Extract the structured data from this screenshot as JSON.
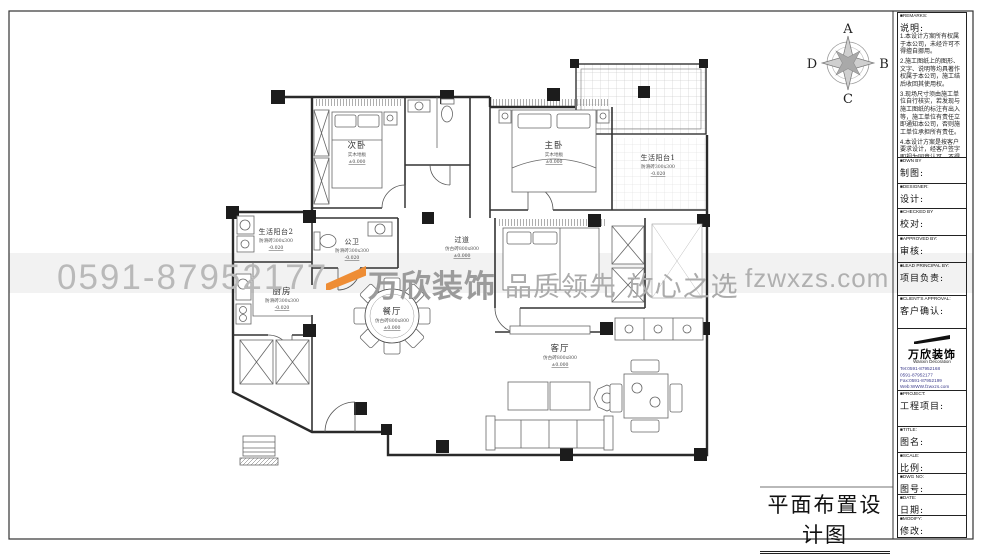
{
  "sheet": {
    "drawing_title": "平面布置设计图",
    "compass": {
      "top": "A",
      "right": "B",
      "bottom": "C",
      "left": "D"
    }
  },
  "watermark": {
    "phone": "0591-87952177",
    "brand": "万欣装饰",
    "slogan": "品质领先 放心之选",
    "website": "fzwxzs.com",
    "accent_color": "#ee8d35"
  },
  "rooms": {
    "ciwo": {
      "name": "次卧",
      "note": "实木地板",
      "elev": "±0.000"
    },
    "zhuwo": {
      "name": "主卧",
      "note": "实木地板",
      "elev": "±0.000"
    },
    "yangtai1": {
      "name": "生活阳台1",
      "note": "防滑砖300x300",
      "elev": "-0.020"
    },
    "yangtai2": {
      "name": "生活阳台2",
      "note": "防滑砖300x300",
      "elev": "-0.020"
    },
    "gongwei": {
      "name": "公卫",
      "note": "防滑砖300x300",
      "elev": "-0.020"
    },
    "guodao": {
      "name": "过道",
      "note": "仿古砖800x800",
      "elev": "±0.000"
    },
    "chufang": {
      "name": "厨房",
      "note": "防滑砖300x300",
      "elev": "-0.020"
    },
    "canting": {
      "name": "餐厅",
      "note": "仿古砖800x800",
      "elev": "±0.000"
    },
    "keting": {
      "name": "客厅",
      "note": "仿古砖800x800",
      "elev": "±0.000"
    }
  },
  "titleblock": {
    "remarks_en": "■REMARKS:",
    "remarks_zh": "说明:",
    "remarks": [
      "1.本设计方案所有权属于本公司，未经许可不得擅自挪用。",
      "2.施工图纸上的图形、文字、说明等均具著作权属于本公司，施工结后收回其使用权。",
      "3.现场尺寸须由施工单位自行核实，若发现与施工图纸的标注有出入等，施工单位有责任立即通知本公司，否则施工单位承担所有责任。",
      "4.本设计方案是按客户要求设计，经客户签字即视为同意认可，不得随意更改。"
    ],
    "fields": [
      {
        "en": "■DWN BY",
        "zh": "制图:"
      },
      {
        "en": "■DESIGNER:",
        "zh": "设计:"
      },
      {
        "en": "■CHECKED BY",
        "zh": "校对:"
      },
      {
        "en": "■APPROVED BY:",
        "zh": "审核:"
      },
      {
        "en": "■LEAD PRINCIPAL BY:",
        "zh": "项目负责:"
      },
      {
        "en": "■CLIENT'S APPROVAL:",
        "zh": "客户确认:"
      },
      {
        "en": "■PROJECT:",
        "zh": "工程项目:"
      },
      {
        "en": "■TITLE:",
        "zh": "图名:"
      },
      {
        "en": "■SCALE:",
        "zh": "比例:"
      },
      {
        "en": "■DWG NO:",
        "zh": "图号:"
      },
      {
        "en": "■DATE:",
        "zh": "日期:"
      },
      {
        "en": "■MODIFY:",
        "zh": "修改:"
      }
    ],
    "company": {
      "name_zh": "万欣装饰",
      "name_en": "Wanxin Decoration",
      "tel1": "Tel:0591-87952168",
      "tel2": "0591-87952177",
      "fax": "Fax:0591-87952199",
      "web": "Web:WWW.fzwxzs.com"
    }
  }
}
